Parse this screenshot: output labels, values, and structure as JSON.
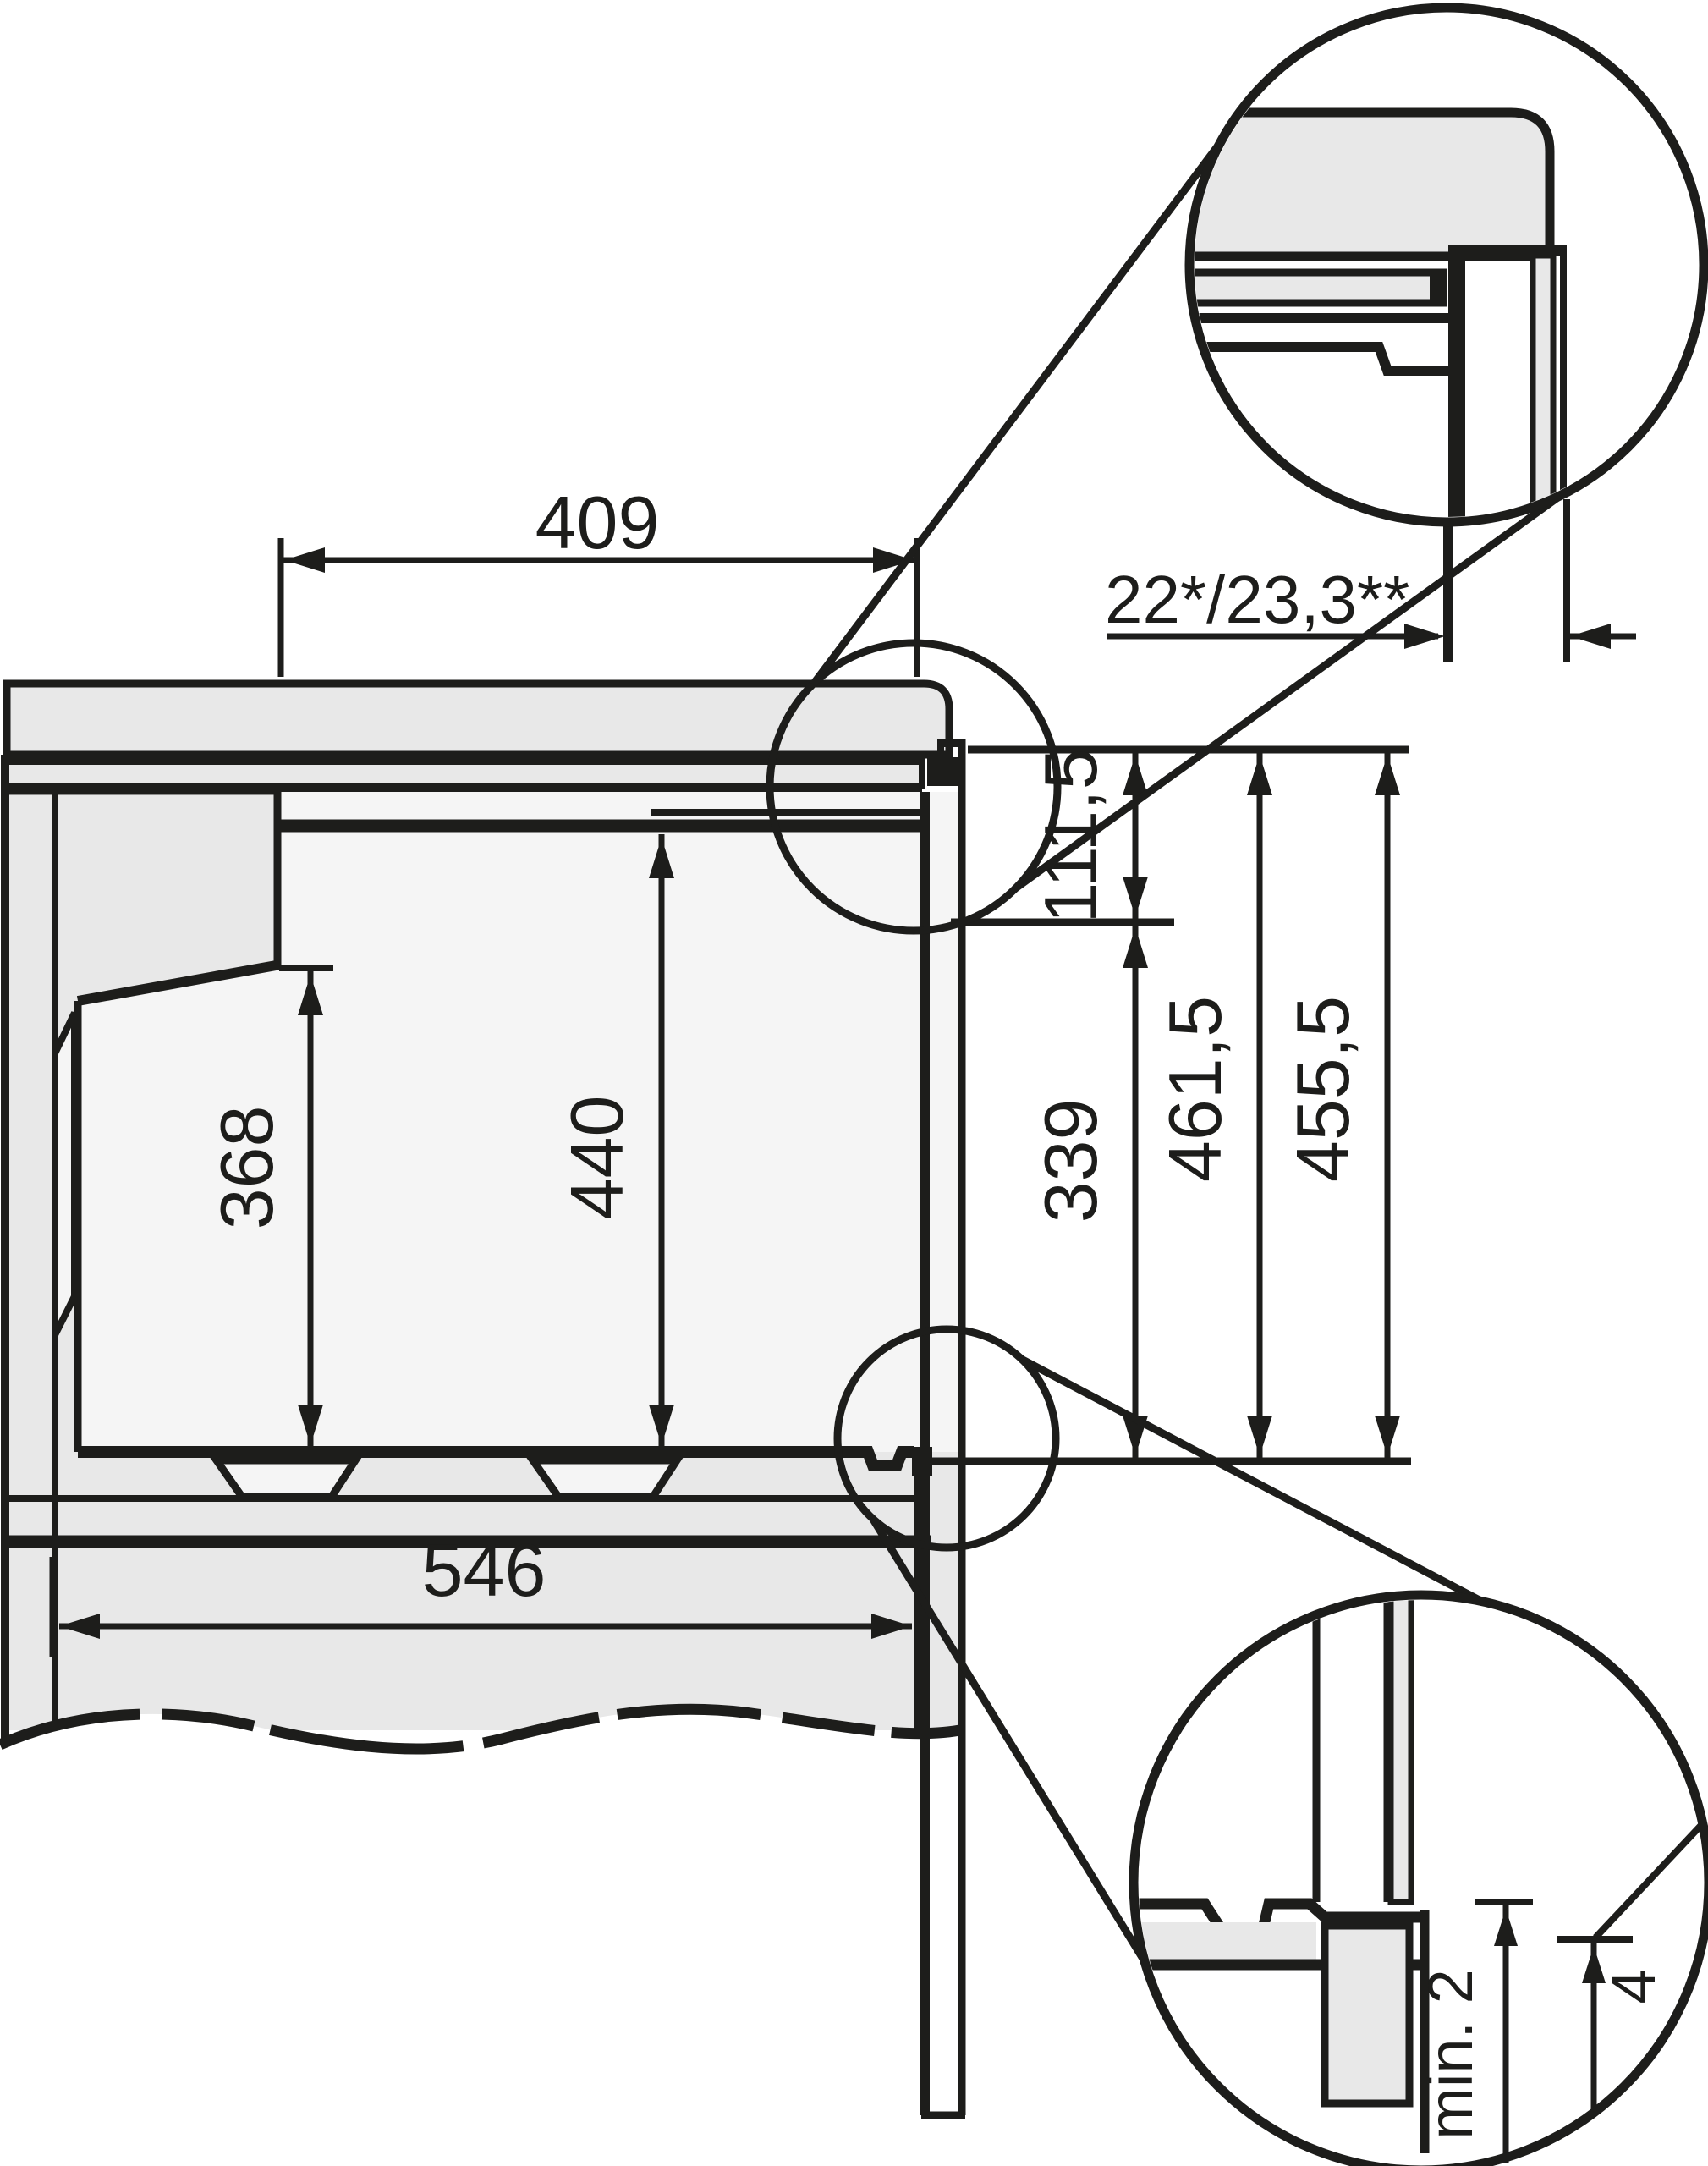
{
  "drawing": {
    "kind": "built-in oven niche installation side-section drawing",
    "colors": {
      "line": "#1d1d1b",
      "panel_gray": "#e8e8e8",
      "void_white": "#f5f5f5",
      "background": "#ffffff"
    },
    "dims": {
      "niche_depth_top": "409",
      "door_protrusion": "22*/23,3**",
      "front_top_gap": "111,5",
      "rear_recess_height": "368",
      "front_opening_height": "440",
      "lower_front_height": "339",
      "height_a": "461,5",
      "height_b": "455,5",
      "cabinet_depth": "546",
      "bottom_gap_min": "min. 2",
      "bottom_gap_trim": "4"
    }
  }
}
